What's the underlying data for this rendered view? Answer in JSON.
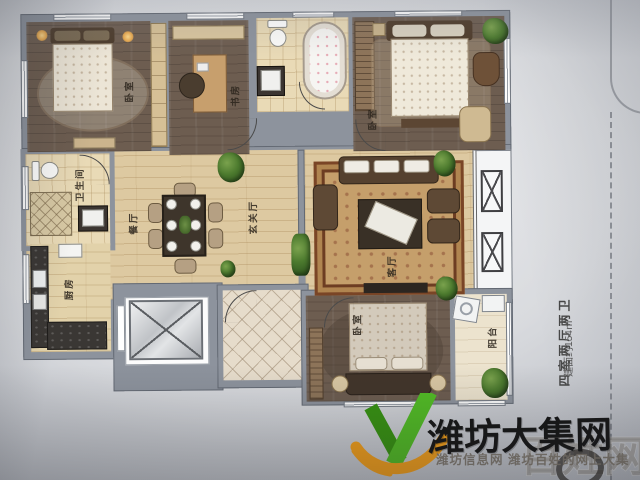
{
  "plan": {
    "rooms": {
      "bedroom_top_left": "卧室",
      "study": "书房",
      "master_bedroom": "卧室",
      "bathroom_left": "卫生间",
      "dining": "餐厅",
      "entry_hall": "玄关厅",
      "kitchen": "厨房",
      "living_room": "客厅",
      "bedroom_bottom": "卧室",
      "balcony": "阳台"
    },
    "annotation": {
      "layout": "四室两厅两卫",
      "area": "建面约154㎡"
    }
  },
  "watermark": {
    "brand": "潍坊大集网",
    "ghost": "百姓网",
    "tagline": "潍坊信息网 潍坊百姓的网上大集",
    "colors": {
      "logo_green": "#52bd25",
      "logo_green_dark": "#379311",
      "logo_orange": "#f4a01b",
      "brand_text": "#161616"
    }
  }
}
